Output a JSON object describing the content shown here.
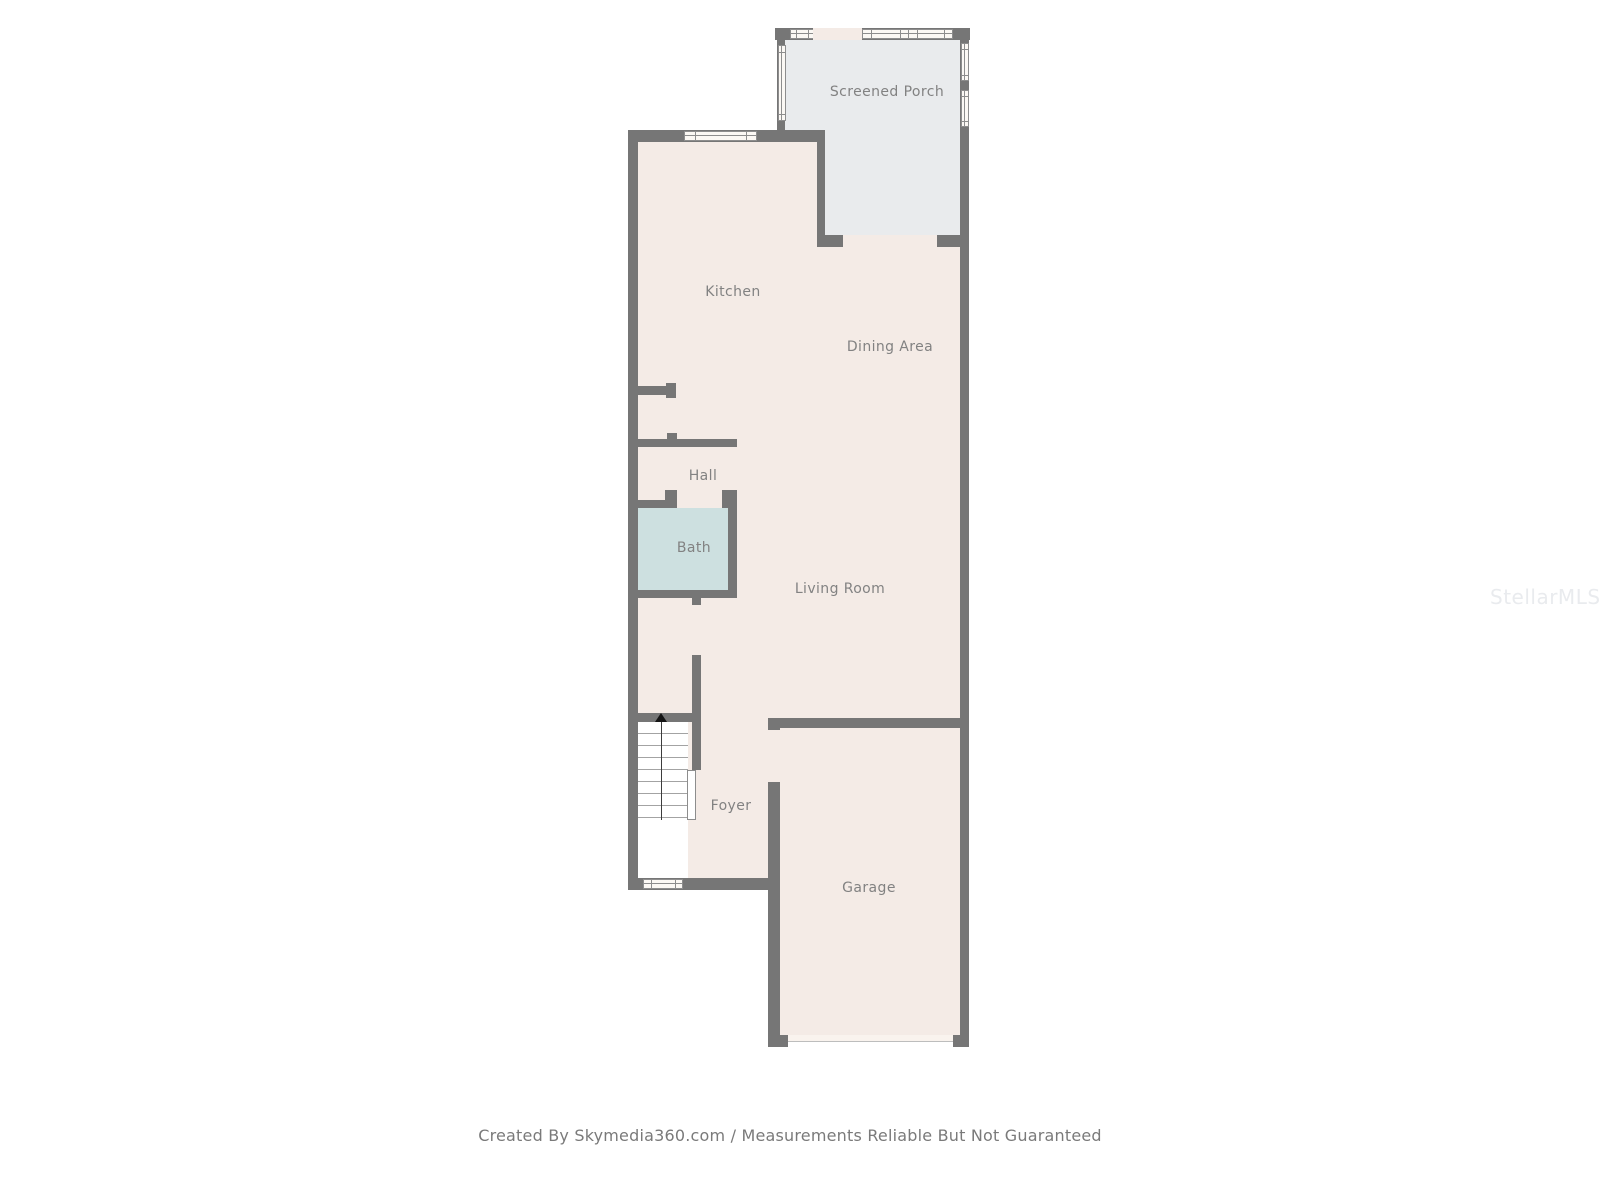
{
  "colors": {
    "wall": "#767676",
    "floor_main": "#f4ebe6",
    "floor_porch": "#e9ebed",
    "floor_bath": "#cde0e0",
    "floor_stairs": "#ffffff",
    "window_fill": "#fbf8f4",
    "window_frame": "#8d8d8d",
    "garage_door": "#f9f3ee",
    "label_text": "#828282",
    "footer_text": "#7a7a7a",
    "watermark_text": "#e9ebee"
  },
  "rooms": {
    "screened_porch": {
      "label": "Screened Porch"
    },
    "kitchen": {
      "label": "Kitchen"
    },
    "dining_area": {
      "label": "Dining Area"
    },
    "hall": {
      "label": "Hall"
    },
    "bath": {
      "label": "Bath"
    },
    "living_room": {
      "label": "Living Room"
    },
    "foyer": {
      "label": "Foyer"
    },
    "garage": {
      "label": "Garage"
    }
  },
  "footer": {
    "credit": "Created By Skymedia360.com / Measurements Reliable But Not Guaranteed"
  },
  "watermark": {
    "text": "StellarMLS"
  }
}
